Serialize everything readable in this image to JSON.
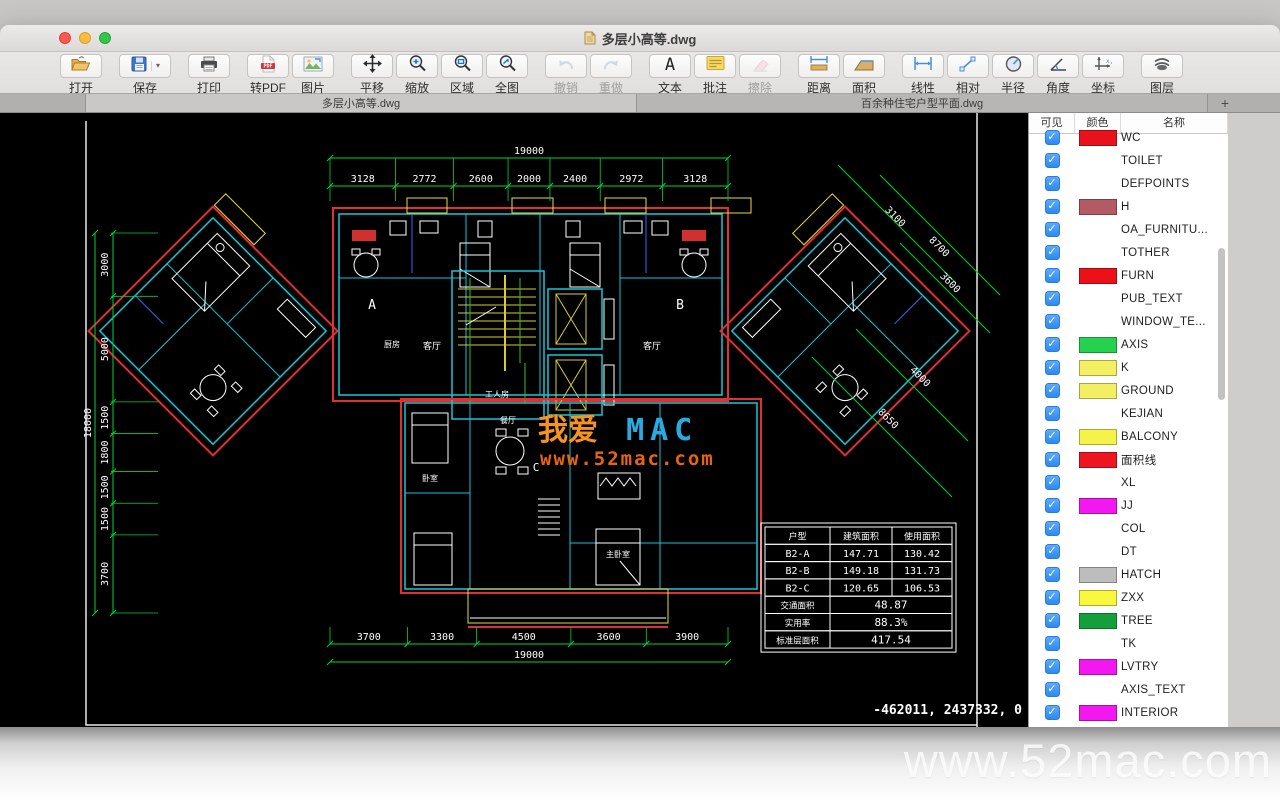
{
  "window": {
    "title": "多层小高等.dwg"
  },
  "toolbar": {
    "groups": [
      {
        "buttons": [
          {
            "id": "open",
            "label": "打开",
            "icon": "open-folder-icon"
          }
        ]
      },
      {
        "buttons": [
          {
            "id": "save",
            "label": "保存",
            "icon": "save-icon",
            "dropdown": true
          }
        ]
      },
      {
        "buttons": [
          {
            "id": "print",
            "label": "打印",
            "icon": "printer-icon"
          }
        ]
      },
      {
        "buttons": [
          {
            "id": "to-pdf",
            "label": "转PDF",
            "icon": "pdf-icon"
          },
          {
            "id": "image",
            "label": "图片",
            "icon": "image-icon"
          }
        ]
      },
      {
        "buttons": [
          {
            "id": "pan",
            "label": "平移",
            "icon": "pan-icon"
          },
          {
            "id": "zoom",
            "label": "缩放",
            "icon": "zoom-in-icon"
          },
          {
            "id": "zoom-region",
            "label": "区域",
            "icon": "zoom-region-icon"
          },
          {
            "id": "zoom-all",
            "label": "全图",
            "icon": "zoom-fit-icon"
          }
        ]
      },
      {
        "buttons": [
          {
            "id": "undo",
            "label": "撤销",
            "icon": "undo-icon",
            "disabled": true
          },
          {
            "id": "redo",
            "label": "重做",
            "icon": "redo-icon",
            "disabled": true
          }
        ]
      },
      {
        "buttons": [
          {
            "id": "text",
            "label": "文本",
            "icon": "text-icon"
          },
          {
            "id": "note",
            "label": "批注",
            "icon": "note-icon"
          },
          {
            "id": "erase",
            "label": "擦除",
            "icon": "eraser-icon",
            "disabled": true
          }
        ]
      },
      {
        "buttons": [
          {
            "id": "distance",
            "label": "距离",
            "icon": "distance-icon"
          },
          {
            "id": "area",
            "label": "面积",
            "icon": "area-icon"
          }
        ]
      },
      {
        "buttons": [
          {
            "id": "linear",
            "label": "线性",
            "icon": "linear-icon"
          },
          {
            "id": "relative",
            "label": "相对",
            "icon": "relative-icon"
          },
          {
            "id": "radius",
            "label": "半径",
            "icon": "radius-icon"
          },
          {
            "id": "angle",
            "label": "角度",
            "icon": "angle-icon"
          },
          {
            "id": "coordinate",
            "label": "坐标",
            "icon": "coordinate-icon"
          }
        ]
      },
      {
        "buttons": [
          {
            "id": "layers",
            "label": "图层",
            "icon": "layers-icon"
          }
        ]
      }
    ]
  },
  "tabs": {
    "items": [
      {
        "label": "多层小高等.dwg",
        "active": true
      },
      {
        "label": "百余种住宅户型平面.dwg",
        "active": false
      }
    ],
    "add_label": "+"
  },
  "layer_panel": {
    "columns": [
      "可见",
      "颜色",
      "名称"
    ],
    "layers": [
      {
        "name": "WC",
        "color": "#e8121c",
        "checked": true
      },
      {
        "name": "TOILET",
        "color": "#ffffff",
        "checked": true
      },
      {
        "name": "DEFPOINTS",
        "color": "#ffffff",
        "checked": true
      },
      {
        "name": "H",
        "color": "#b45a64",
        "checked": true
      },
      {
        "name": "OA_FURNITU...",
        "color": "#ffffff",
        "checked": true
      },
      {
        "name": "TOTHER",
        "color": "#ffffff",
        "checked": true
      },
      {
        "name": "FURN",
        "color": "#ec1118",
        "checked": true
      },
      {
        "name": "PUB_TEXT",
        "color": "#ffffff",
        "checked": true
      },
      {
        "name": "WINDOW_TE...",
        "color": "#ffffff",
        "checked": true
      },
      {
        "name": "AXIS",
        "color": "#25d14e",
        "checked": true
      },
      {
        "name": "K",
        "color": "#f2ef63",
        "checked": true
      },
      {
        "name": "GROUND",
        "color": "#f2ef63",
        "checked": true
      },
      {
        "name": "KEJIAN",
        "color": "#ffffff",
        "checked": true
      },
      {
        "name": "BALCONY",
        "color": "#f5f24a",
        "checked": true
      },
      {
        "name": "面积线",
        "color": "#ee1420",
        "checked": true
      },
      {
        "name": "XL",
        "color": "#ffffff",
        "checked": true
      },
      {
        "name": "JJ",
        "color": "#f318f0",
        "checked": true
      },
      {
        "name": "COL",
        "color": "#ffffff",
        "checked": true
      },
      {
        "name": "DT",
        "color": "#ffffff",
        "checked": true
      },
      {
        "name": "HATCH",
        "color": "#bdbdbd",
        "checked": true
      },
      {
        "name": "ZXX",
        "color": "#f8f83e",
        "checked": true
      },
      {
        "name": "TREE",
        "color": "#13a03c",
        "checked": true
      },
      {
        "name": "TK",
        "color": "#ffffff",
        "checked": true
      },
      {
        "name": "LVTRY",
        "color": "#f318f0",
        "checked": true
      },
      {
        "name": "AXIS_TEXT",
        "color": "#ffffff",
        "checked": true
      },
      {
        "name": "INTERIOR",
        "color": "#f318f0",
        "checked": true
      },
      {
        "name": "",
        "color": "#f318f0",
        "checked": true
      }
    ]
  },
  "drawing": {
    "overall_width_label": "19000",
    "overall_height_label": "18000",
    "bottom_overall_label": "19000",
    "top_segments": [
      "3128",
      "2772",
      "2600",
      "2000",
      "2400",
      "2972",
      "3128"
    ],
    "bottom_segments": [
      "3700",
      "3300",
      "4500",
      "3600",
      "3900"
    ],
    "left_segments": [
      "3000",
      "5000",
      "1500",
      "1800",
      "1500",
      "1500",
      "3700"
    ],
    "right_segments": [
      "3100",
      "8700",
      "3600",
      "4000",
      "8650"
    ],
    "plan_labels": [
      "A",
      "B",
      "C",
      "客厅",
      "客厅",
      "餐厅",
      "工人房",
      "主卧室",
      "卧室",
      "厨房"
    ],
    "area_table": {
      "headers": [
        "户型",
        "建筑面积",
        "使用面积"
      ],
      "rows": [
        [
          "B2-A",
          "147.71",
          "130.42"
        ],
        [
          "B2-B",
          "149.18",
          "131.73"
        ],
        [
          "B2-C",
          "120.65",
          "106.53"
        ]
      ],
      "summary": [
        [
          "交通面积",
          "48.87"
        ],
        [
          "实用率",
          "88.3%"
        ],
        [
          "标准层面积",
          "417.54"
        ]
      ]
    },
    "watermark": {
      "part1": "我爱",
      "part2": "MAC",
      "url": "www.52mac.com"
    },
    "status_coordinates": "-462011, 2437332, 0"
  },
  "footer": {
    "watermark": "www.52mac.com"
  },
  "colors": {
    "dim_green": "#00d23c",
    "wall_cyan": "#18c5d8",
    "accent_red": "#e03131",
    "accent_yellow": "#e8de3f",
    "accent_blue": "#2f6bff",
    "wm_orange": "#f7941d",
    "wm_blue": "#29abe2",
    "wm_url": "#e8650f"
  }
}
